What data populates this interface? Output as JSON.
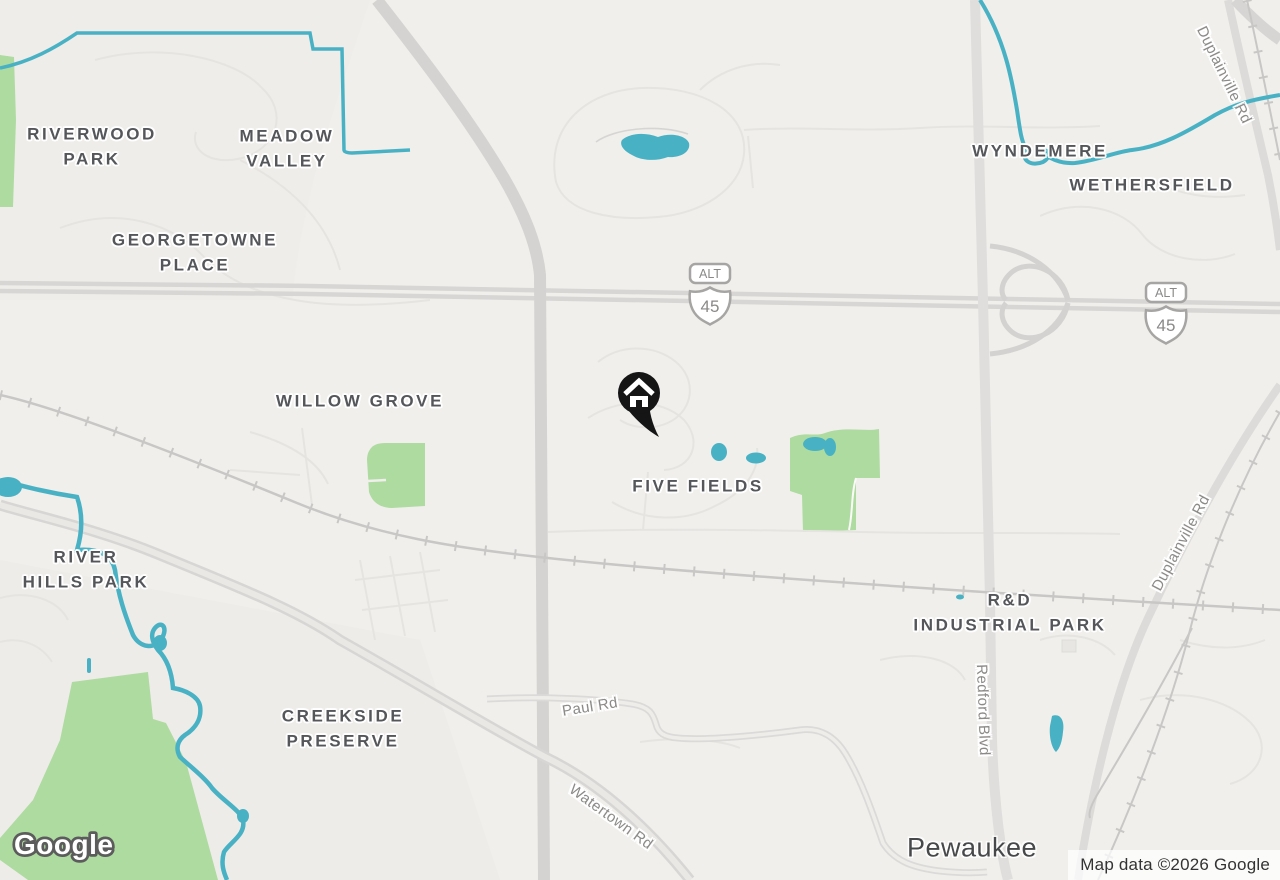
{
  "map": {
    "attribution": "Map data ©2026 Google",
    "logo_text": "Google",
    "marker": {
      "type": "home"
    },
    "shield": {
      "banner": "ALT",
      "route": "45"
    },
    "neighborhoods": {
      "riverwood_park": "RIVERWOOD\nPARK",
      "meadow_valley": "MEADOW\nVALLEY",
      "georgetowne_place": "GEORGETOWNE\nPLACE",
      "wyndemere": "WYNDEMERE",
      "wethersfield": "WETHERSFIELD",
      "willow_grove": "WILLOW GROVE",
      "five_fields": "FIVE FIELDS",
      "river_hills_park": "RIVER\nHILLS PARK",
      "creekside_preserve": "CREEKSIDE\nPRESERVE",
      "rd_industrial_park": "R&D\nINDUSTRIAL PARK"
    },
    "city_labels": {
      "pewaukee": "Pewaukee"
    },
    "road_labels": {
      "duplainville_rd_north": "Duplainville Rd",
      "duplainville_rd_south": "Duplainville Rd",
      "redford_blvd": "Redford Blvd",
      "paul_rd": "Paul Rd",
      "watertown_rd": "Watertown Rd"
    },
    "colors": {
      "background": "#f0efec",
      "park_green": "#aedba0",
      "water_teal": "#48b2c4",
      "major_road": "#d6d5d3",
      "railroad": "#c8c7c5",
      "marker_black": "#151515"
    }
  }
}
